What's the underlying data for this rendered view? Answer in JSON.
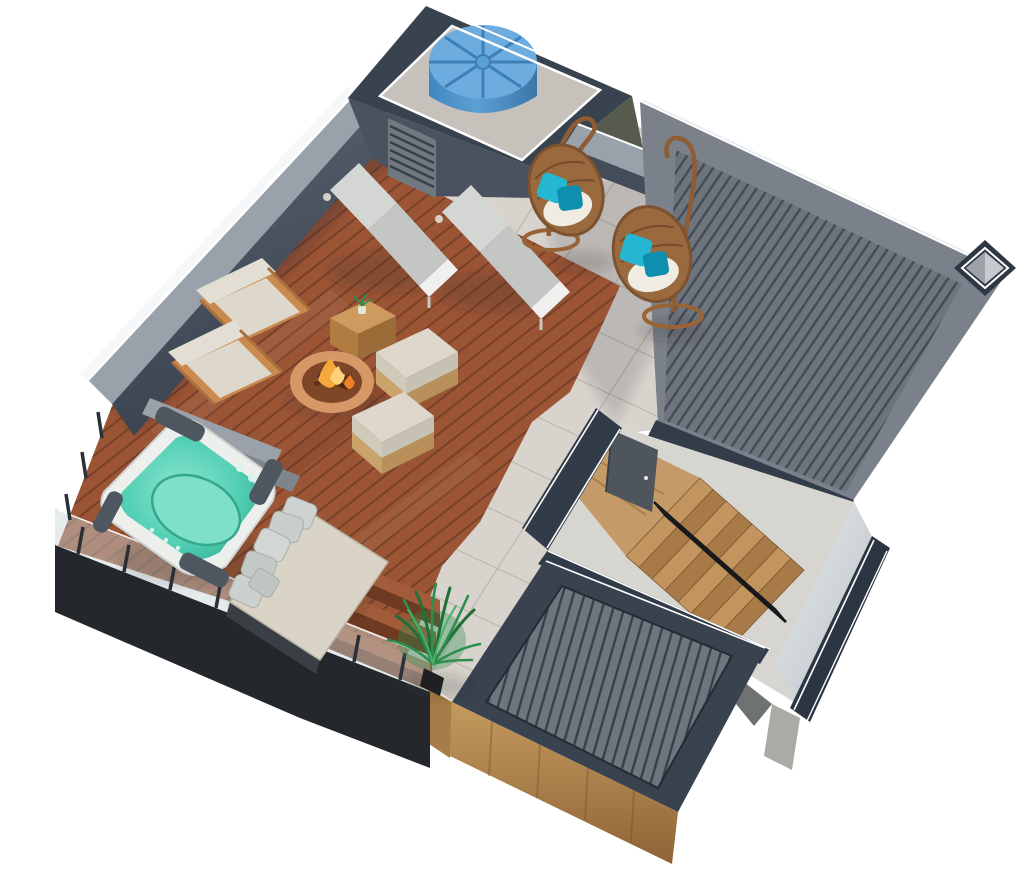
{
  "scene": {
    "description": "3D aerial rendering of a rooftop terrace floor plan with hot tub, wood deck, tile path, lounge furniture, stairwell and slatted roofs",
    "objects": [
      {
        "name": "water-tank",
        "label": "blue rooftop water tank",
        "count": 1
      },
      {
        "name": "tank-enclosure",
        "label": "walled tank enclosure with louver vent",
        "count": 1
      },
      {
        "name": "hanging-egg-chair",
        "label": "rattan hanging egg chair with teal pillows",
        "count": 2
      },
      {
        "name": "sun-lounger",
        "label": "gray cushioned sun lounger",
        "count": 2
      },
      {
        "name": "wicker-armchair",
        "label": "wicker lounge chair with cream cushion",
        "count": 2
      },
      {
        "name": "wicker-side-table",
        "label": "wicker cube side table with plant",
        "count": 1
      },
      {
        "name": "fire-pit",
        "label": "round copper fire pit bowl",
        "count": 1
      },
      {
        "name": "ottoman",
        "label": "wicker ottoman with cream cushion",
        "count": 2
      },
      {
        "name": "hot-tub",
        "label": "square hot tub with teal water",
        "count": 1
      },
      {
        "name": "deck-bench",
        "label": "gray deck bench",
        "count": 2
      },
      {
        "name": "daybed",
        "label": "daybed with gray pillows",
        "count": 1
      },
      {
        "name": "potted-palm",
        "label": "potted palm plant",
        "count": 1
      },
      {
        "name": "staircase",
        "label": "wooden staircase with black handrail",
        "count": 1
      },
      {
        "name": "stair-door",
        "label": "open gray access door",
        "count": 1
      },
      {
        "name": "skylight",
        "label": "square roof skylight",
        "count": 1
      },
      {
        "name": "slatted-roof",
        "label": "large gray slatted roof",
        "count": 1
      },
      {
        "name": "slatted-pergola",
        "label": "lower slatted roof with wood siding",
        "count": 1
      },
      {
        "name": "glass-railing",
        "label": "glass railing with dark posts",
        "count": 1
      },
      {
        "name": "tile-path",
        "label": "light stone tile path",
        "count": 1
      },
      {
        "name": "wood-deck",
        "label": "reddish-brown plank deck",
        "count": 1
      }
    ]
  },
  "colors": {
    "background": "#ffffff",
    "wall_top": "#99a1ab",
    "wall_face": "#4b5563",
    "trim_white": "#f5f7f8",
    "enclosure_dark": "#39434f",
    "enclosure_face": "#49525e",
    "enclosure_face_olive": "#565b4e",
    "courtyard": "#c6c1ba",
    "tank_blue": "#6cacdf",
    "tank_groove": "#3f7fb7",
    "tile": "#d8d3cc",
    "tile_grout": "#bcb5ad",
    "deck": "#9b5434",
    "deck_groove": "#76412a",
    "roof": "#7b818a",
    "fascia_navy": "#333d49",
    "stair_wall": "#323c48",
    "interior_floor": "#d7d5d0",
    "stair_wood": "#c2955f",
    "stair_wood_dark": "#a87a47",
    "landing_wood": "#c59a69",
    "door_gray": "#4f555c",
    "pergola_rim": "#39434f",
    "wood_siding": "#b98a52",
    "fascia_dark": "#24282d",
    "glass": "#c7d4da",
    "post_dark": "#2a3038",
    "shell_white": "#edefed",
    "water_teal": "#45c9ae",
    "water_light": "#7fe0c9",
    "pad_gray": "#4e565f",
    "bench_gray": "#9aa1a8",
    "bench_gray_dark": "#7e858d",
    "cushion_cream": "#ddd8cb",
    "cushion_light": "#d4d6d3",
    "cushion_seat": "#c3c6c3",
    "wicker": "#c9894f",
    "rattan": "#9a6a3e",
    "pillow_teal": "#25b6d2",
    "pillow_teal_dark": "#0f8fb0",
    "pillow_gray": "#c8cecc",
    "mattress": "#d9d4c6",
    "fire_copper": "#d79868",
    "fire_inner": "#7e4526",
    "flame": "#f6a83c",
    "plant_green": "#2e8f4d",
    "plant_green_dark": "#1f7038",
    "pot_black": "#1e2022",
    "metal_black": "#16181b",
    "column_gray": "#a9aca4",
    "sun_wall": "#d3d7da"
  }
}
